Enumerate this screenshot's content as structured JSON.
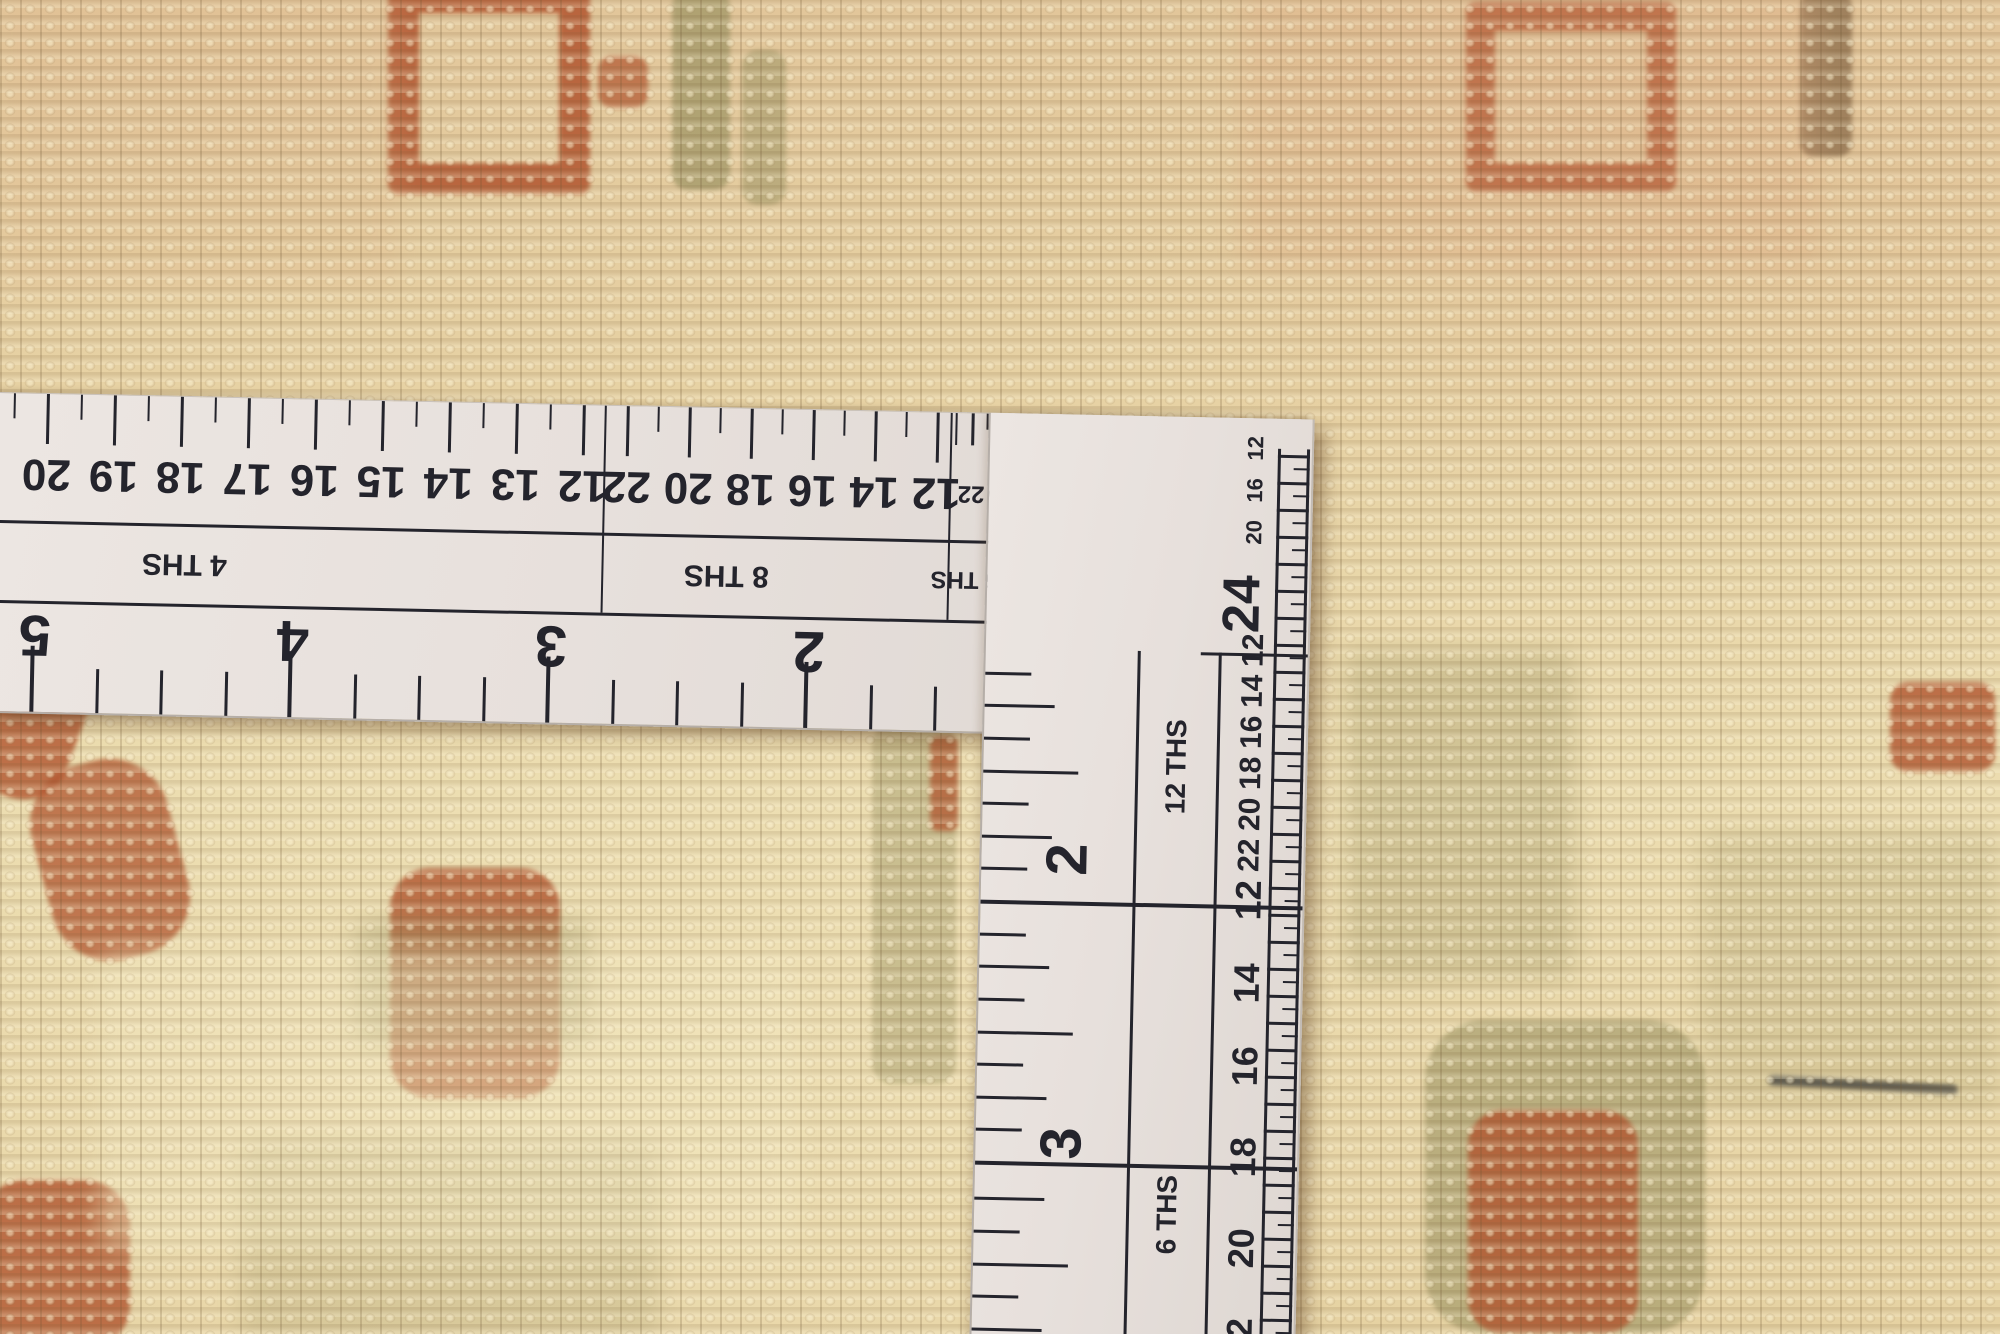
{
  "ruler": {
    "body_color": "#e9e3de",
    "ink_color": "#24242c",
    "hole_color": "#c2a87b",
    "horizontal_arm": {
      "sections": [
        {
          "label": "4 THS",
          "numbers": [
            "20",
            "19",
            "18",
            "17",
            "16",
            "15",
            "14",
            "13",
            "12"
          ]
        },
        {
          "label": "8 THS",
          "numbers": [
            "22",
            "20",
            "18",
            "16",
            "14",
            "12"
          ]
        },
        {
          "label": "16 THS",
          "numbers": [
            "22",
            "20",
            "18",
            "16",
            "14",
            "12"
          ]
        },
        {
          "label": "32",
          "numbers": [
            "20",
            "16",
            "12"
          ]
        }
      ],
      "inch_numbers": [
        "5",
        "4",
        "3",
        "2"
      ]
    },
    "vertical_arm": {
      "end_number": "24",
      "corner_numbers": [
        "12",
        "16",
        "20"
      ],
      "edge_numbers": [
        "12",
        "14",
        "16",
        "18",
        "20",
        "22",
        "12",
        "14",
        "16",
        "18",
        "20",
        "22"
      ],
      "sections": [
        {
          "label": "12 THS",
          "inch_number": "2"
        },
        {
          "label": "6 THS",
          "inch_number": "3"
        }
      ]
    }
  },
  "rug": {
    "colors": {
      "base": "#e5cda0",
      "light": "#f3e6c2",
      "shadow": "#a98f63",
      "rust": "#b2552f",
      "olive": "#968f5e",
      "brown": "#8a6b4a",
      "thread": "#3a3a38",
      "pink": "#dca77f",
      "cream": "#f3e8c0"
    },
    "motifs": [
      {
        "name": "rust-hollow-square-motif",
        "x": 388,
        "y": -18,
        "w": 140,
        "h": 150,
        "color": "rust",
        "opacity": 0.85,
        "hollow": true,
        "radius": 10
      },
      {
        "name": "rust-dot-motif",
        "x": 598,
        "y": 56,
        "w": 50,
        "h": 52,
        "color": "rust",
        "opacity": 0.7,
        "radius": 14
      },
      {
        "name": "olive-strip-motif",
        "x": 672,
        "y": -10,
        "w": 58,
        "h": 200,
        "color": "olive",
        "opacity": 0.65,
        "radius": 16
      },
      {
        "name": "olive-strip-motif",
        "x": 742,
        "y": 50,
        "w": 44,
        "h": 155,
        "color": "olive",
        "opacity": 0.5,
        "radius": 16
      },
      {
        "name": "rust-hollow-square-motif",
        "x": 1466,
        "y": 2,
        "w": 152,
        "h": 132,
        "color": "rust",
        "opacity": 0.85,
        "hollow": true,
        "radius": 10
      },
      {
        "name": "brown-strip-motif",
        "x": 1800,
        "y": -8,
        "w": 52,
        "h": 165,
        "color": "brown",
        "opacity": 0.75,
        "radius": 14
      },
      {
        "name": "pink-wash",
        "x": 1240,
        "y": -10,
        "w": 580,
        "h": 280,
        "color": "pink",
        "opacity": 0.25,
        "wash": true
      },
      {
        "name": "pink-wash",
        "x": 0,
        "y": -10,
        "w": 400,
        "h": 300,
        "color": "pink",
        "opacity": 0.15,
        "wash": true
      },
      {
        "name": "rust-scroll-motif",
        "x": -30,
        "y": 648,
        "w": 110,
        "h": 150,
        "color": "rust",
        "opacity": 0.8,
        "radius": 45,
        "rotate": 20
      },
      {
        "name": "rust-scroll-motif",
        "x": 40,
        "y": 760,
        "w": 140,
        "h": 200,
        "color": "rust",
        "opacity": 0.75,
        "radius": 60,
        "rotate": -15
      },
      {
        "name": "rust-plant-motif",
        "x": 390,
        "y": 868,
        "w": 170,
        "h": 230,
        "color": "rust",
        "opacity": 0.8,
        "radius": 40
      },
      {
        "name": "olive-patch",
        "x": 355,
        "y": 920,
        "w": 235,
        "h": 125,
        "color": "olive",
        "opacity": 0.35,
        "wash": true
      },
      {
        "name": "rust-blob-motif",
        "x": -20,
        "y": 1180,
        "w": 150,
        "h": 170,
        "color": "rust",
        "opacity": 0.8,
        "radius": 45
      },
      {
        "name": "olive-column-motif",
        "x": 872,
        "y": 724,
        "w": 84,
        "h": 360,
        "color": "olive",
        "opacity": 0.4,
        "radius": 20
      },
      {
        "name": "rust-dash-motif",
        "x": 930,
        "y": 736,
        "w": 28,
        "h": 95,
        "color": "rust",
        "opacity": 0.75,
        "radius": 8
      },
      {
        "name": "olive-wash",
        "x": 1345,
        "y": 650,
        "w": 230,
        "h": 330,
        "color": "olive",
        "opacity": 0.3,
        "wash": true
      },
      {
        "name": "rust-motif",
        "x": 1890,
        "y": 682,
        "w": 105,
        "h": 90,
        "color": "rust",
        "opacity": 0.8,
        "radius": 18
      },
      {
        "name": "green-wash",
        "x": 1700,
        "y": 830,
        "w": 300,
        "h": 280,
        "color": "olive",
        "opacity": 0.2,
        "wash": true
      },
      {
        "name": "olive-diamond-motif",
        "x": 1425,
        "y": 1020,
        "w": 280,
        "h": 314,
        "color": "olive",
        "opacity": 0.55,
        "radius": 60
      },
      {
        "name": "rust-diamond-motif",
        "x": 1468,
        "y": 1110,
        "w": 170,
        "h": 224,
        "color": "rust",
        "opacity": 0.8,
        "radius": 35
      },
      {
        "name": "black-thread",
        "x": 1768,
        "y": 1080,
        "w": 190,
        "h": 10,
        "color": "thread",
        "opacity": 0.75,
        "radius": 5,
        "rotate": 3
      },
      {
        "name": "olive-patch",
        "x": 1100,
        "y": 1150,
        "w": 140,
        "h": 130,
        "color": "olive",
        "opacity": 0.35,
        "wash": true
      },
      {
        "name": "rust-motif",
        "x": 1055,
        "y": 1245,
        "w": 200,
        "h": 95,
        "color": "rust",
        "opacity": 0.6,
        "radius": 28
      },
      {
        "name": "green-wash",
        "x": 240,
        "y": 1140,
        "w": 420,
        "h": 200,
        "color": "olive",
        "opacity": 0.22,
        "wash": true
      },
      {
        "name": "cream-wash",
        "x": 100,
        "y": 950,
        "w": 700,
        "h": 300,
        "color": "cream",
        "opacity": 0.45,
        "wash": true
      }
    ]
  }
}
